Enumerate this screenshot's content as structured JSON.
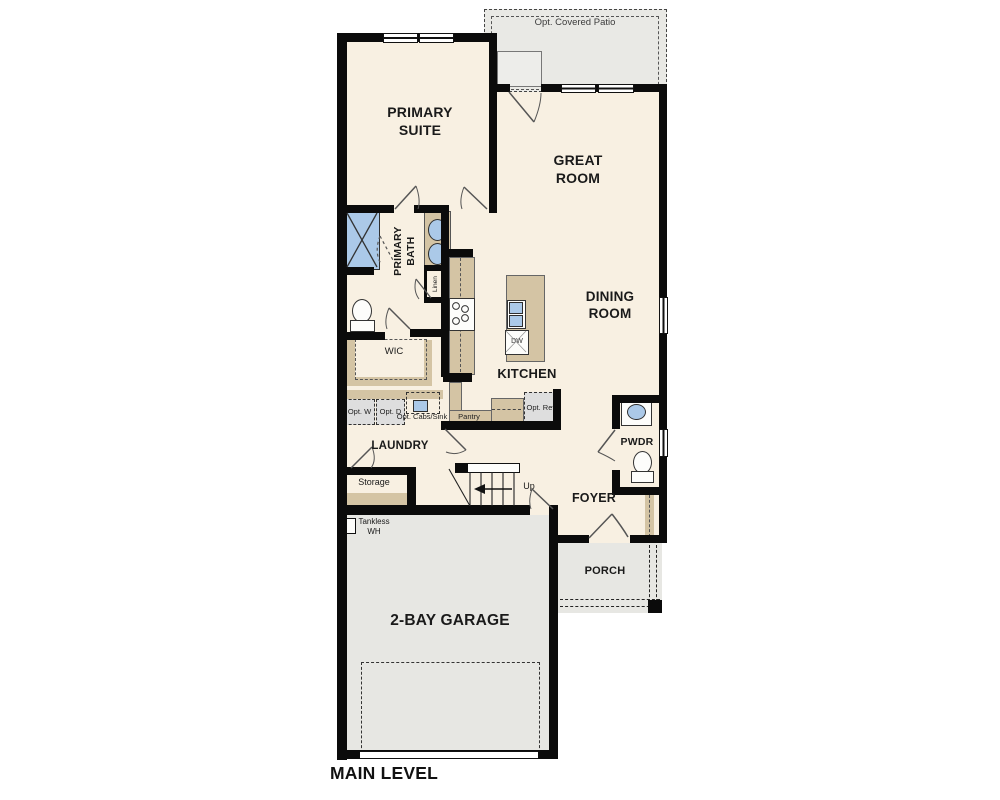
{
  "plan_title": "MAIN LEVEL",
  "colors": {
    "floor_cream": "#f8f0e2",
    "wall_black": "#0b0b0b",
    "counter_tan": "#d4c4a4",
    "concrete_gray": "#e7e7e3",
    "fixture_blue": "#abc9e8",
    "appliance_gray": "#dedede"
  },
  "rooms": {
    "primary_suite": "PRIMARY SUITE",
    "great_room": "GREAT ROOM",
    "dining_room": "DINING ROOM",
    "kitchen": "KITCHEN",
    "primary_bath": "PRIMARY BATH",
    "wic": "WIC",
    "laundry": "LAUNDRY",
    "storage": "Storage",
    "foyer": "FOYER",
    "pwdr": "PWDR",
    "porch": "PORCH",
    "garage": "2-BAY GARAGE"
  },
  "features": {
    "opt_covered_patio": "Opt. Covered Patio",
    "linen": "Linen",
    "pantry": "Pantry",
    "opt_ref": "Opt. Ref",
    "opt_w": "Opt. W",
    "opt_d": "Opt. D",
    "opt_cabs_sink": "Opt. Cabs/Sink",
    "dw": "DW",
    "tankless_wh": "Tankless WH",
    "up": "Up"
  }
}
